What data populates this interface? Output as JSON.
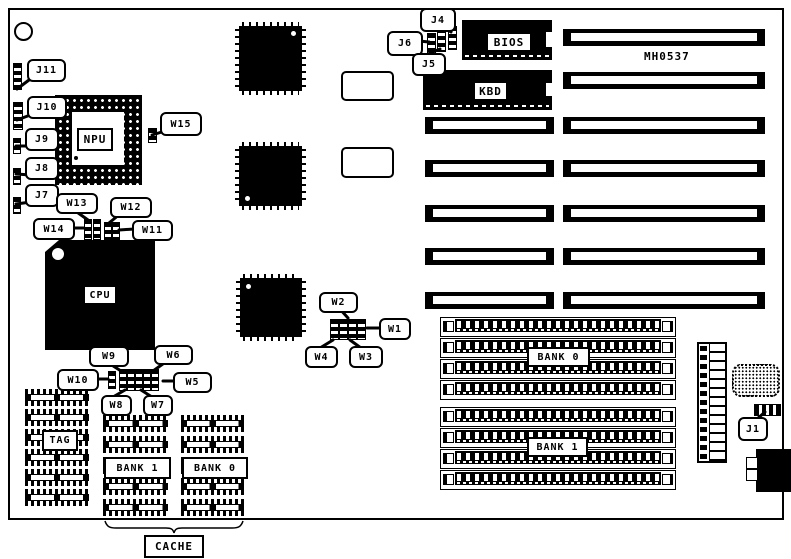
{
  "board": {
    "part_number": "MH0537"
  },
  "chips": {
    "npu": "NPU",
    "cpu": "CPU",
    "bios": "BIOS",
    "kbd": "KBD"
  },
  "cache": {
    "tag": "TAG",
    "bank1": "BANK 1",
    "bank0": "BANK 0",
    "group": "CACHE"
  },
  "simm": {
    "bank0": "BANK 0",
    "bank1": "BANK 1"
  },
  "jumpers": {
    "j1": "J1",
    "j4": "J4",
    "j5": "J5",
    "j6": "J6",
    "j7": "J7",
    "j8": "J8",
    "j9": "J9",
    "j10": "J10",
    "j11": "J11",
    "w1": "W1",
    "w2": "W2",
    "w3": "W3",
    "w4": "W4",
    "w5": "W5",
    "w6": "W6",
    "w7": "W7",
    "w8": "W8",
    "w9": "W9",
    "w10": "W10",
    "w11": "W11",
    "w12": "W12",
    "w13": "W13",
    "w14": "W14",
    "w15": "W15"
  },
  "colors": {
    "ink": "#000000",
    "board_bg": "#ffffff"
  }
}
